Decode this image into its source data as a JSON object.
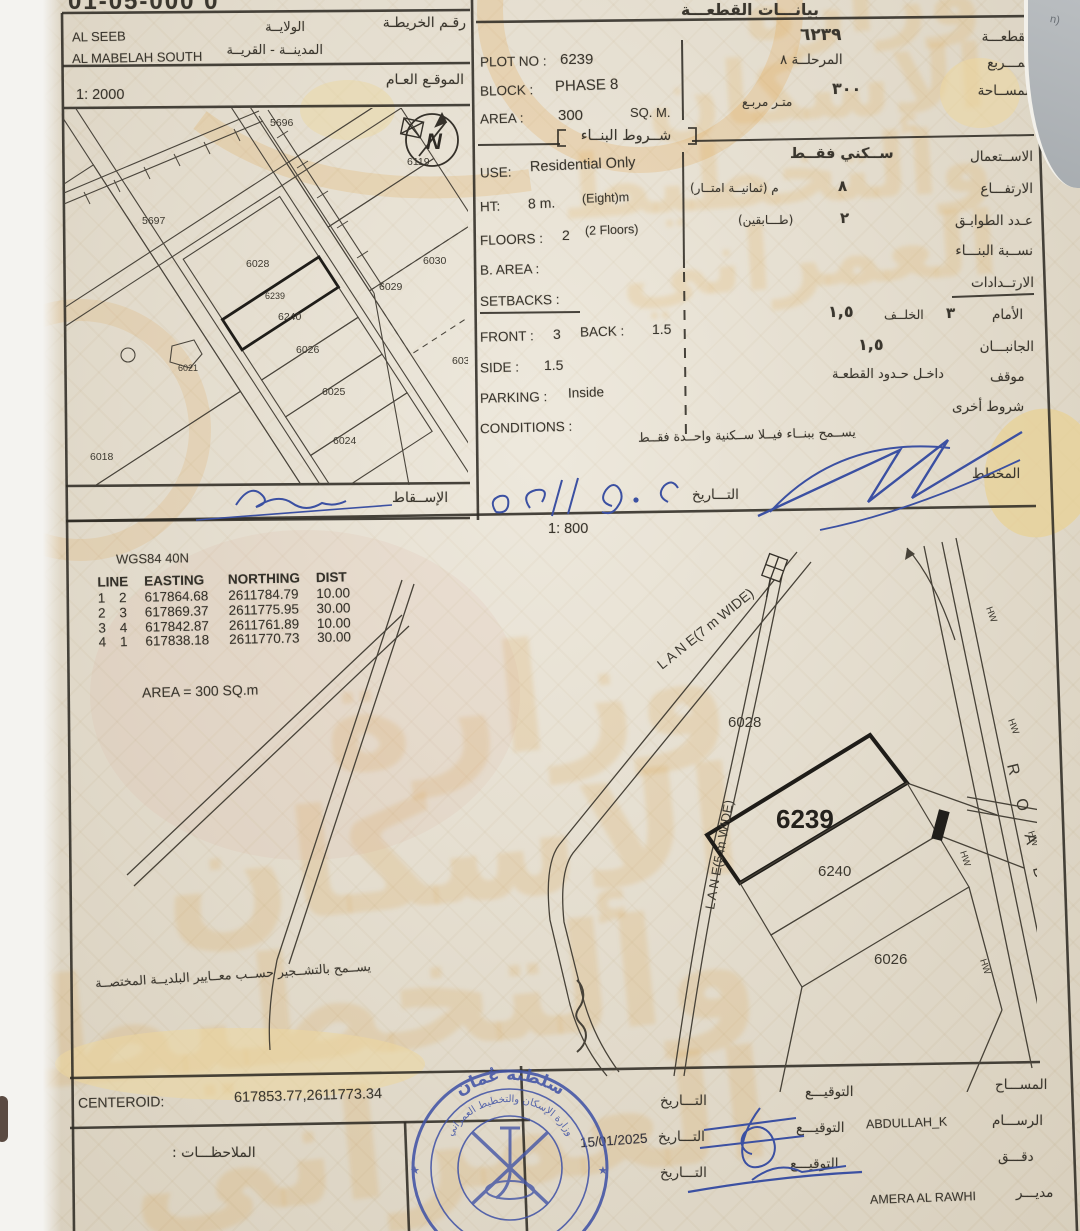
{
  "colors": {
    "paper": "#e7e0d0",
    "ink": "#3a362e",
    "ink_blue": "#3a4fa0",
    "stamp_blue": "#4254a6",
    "watermark_orange": "#d89232"
  },
  "backdrop": {
    "corner_text": "n)"
  },
  "header": {
    "doc_number": "01-05-000 0"
  },
  "location": {
    "map_number_label_ar": "رقـم الخريطـة",
    "wilaya_label_ar": "الولايــة",
    "wilaya_value": "AL SEEB",
    "city_label_ar": "المدينــة - القريــة",
    "city_value": "AL MABELAH SOUTH",
    "site_label_ar": "الموقـع العـام",
    "scale": "1: 2000",
    "projection_label_ar": "الإســقاط"
  },
  "plot": {
    "header_ar": "بيانـــات القطعـــة",
    "plot_label_ar": "القطعـــة",
    "plot_value_ar": "٦٢٣٩",
    "block_label_ar": "المـــربع",
    "block_value_ar": "المرحلــة ٨",
    "area_label_ar": "المســاحة",
    "area_value_ar": "٣٠٠",
    "area_unit_ar": "متـر مربـع",
    "plot_no_label": "PLOT NO :",
    "plot_no": "6239",
    "block_label": "BLOCK :",
    "block": "PHASE 8",
    "area_label": "AREA :",
    "area": "300",
    "area_unit": "SQ. M."
  },
  "conditions": {
    "header_ar": "شــروط البنــاء",
    "use_label_ar": "الاســتعمال",
    "use_value_ar": "ســكني فقــط",
    "height_label_ar": "الارتفـــاع",
    "height_value_ar": "٨",
    "height_note_ar": "م  (ثمانيــة امتــار)",
    "floors_label_ar": "عـدد الطوابـق",
    "floors_value_ar": "٢",
    "floors_note_ar": "(طـــابقين)",
    "ratio_label_ar": "نســبة البنـــاء",
    "setbacks_label_ar": "الارتــدادات",
    "front_label_ar": "الأمام",
    "front_value_ar": "٣",
    "back_label_ar": "الخلــف",
    "back_value_ar": "١,٥",
    "sides_label_ar": "الجانبـــان",
    "sides_value_ar": "١,٥",
    "parking_label_ar": "موقف",
    "parking_value_ar": "داخـل حـدود القطعـة",
    "other_label_ar": "شروط أخرى",
    "note_ar": "يســمح ببنــاء فيــلا ســكنية واحــدة فقــط",
    "planner_label_ar": "المخطط",
    "date_label_ar": "التـــاريخ",
    "use_label": "USE:",
    "use_value": "Residential Only",
    "ht_label": "HT:",
    "ht_value": "8 m.",
    "ht_note": "(Eight)m",
    "floors_label": "FLOORS :",
    "floors_value": "2",
    "floors_note": "(2 Floors)",
    "b_area_label": "B. AREA :",
    "setbacks_label": "SETBACKS :",
    "front_label": "FRONT :",
    "front_value": "3",
    "back_label": "BACK :",
    "back_value": "1.5",
    "side_label": "SIDE :",
    "side_value": "1.5",
    "parking_label": "PARKING :",
    "parking_value": "Inside",
    "conditions_label": "CONDITIONS :"
  },
  "survey": {
    "datum": "WGS84 40N",
    "cols": [
      "LINE",
      "EASTING",
      "NORTHING",
      "DIST"
    ],
    "rows": [
      [
        "1",
        "2",
        "617864.68",
        "2611784.79",
        "10.00"
      ],
      [
        "2",
        "3",
        "617869.37",
        "2611775.95",
        "30.00"
      ],
      [
        "3",
        "4",
        "617842.87",
        "2611761.89",
        "10.00"
      ],
      [
        "4",
        "1",
        "617838.18",
        "2611770.73",
        "30.00"
      ]
    ],
    "area_note": "AREA = 300 SQ.m",
    "scale": "1: 800",
    "greening_note_ar": "يســمح بالتشــجير حســب معــايير البلديــة المختصــة"
  },
  "small_map": {
    "north": "N",
    "plots": {
      "p5696": "5696",
      "p5697": "5697",
      "p6028": "6028",
      "p6030": "6030",
      "p6029": "6029",
      "p6239": "6239",
      "p6240": "6240",
      "p6026": "6026",
      "p6021": "6021",
      "p6025": "6025",
      "p6024": "6024",
      "p6034": "6034",
      "p6018": "6018",
      "p6119": "6119"
    }
  },
  "site_plan": {
    "lane7": "L A N E(7 m WIDE)",
    "lane5": "L A N E(5 m WIDE)",
    "road": "R O A D",
    "hw": "HW",
    "p6028": "6028",
    "p6239": "6239",
    "p6240": "6240",
    "p6026": "6026"
  },
  "footer": {
    "centeroid_label": "CENTEROID:",
    "centeroid_value": "617853.77,2611773.34",
    "notes_label_ar": "الملاحظـــات :",
    "surveyor_label_ar": "المســـاح",
    "sign_label_ar": "التوقيـــع",
    "date_label_ar": "التـــاريخ",
    "draftsman_label_ar": "الرســـام",
    "draftsman_name": "ABDULLAH_K",
    "checked_label_ar": "دقـــق",
    "director_label_ar": "مديـــر",
    "director_name": "AMERA AL RAWHI",
    "date_value": "15/01/2025"
  },
  "stamp": {
    "country_ar": "سلطنة عُمان",
    "ministry_ar": "وزارة الإسكان والتخطيط العمراني",
    "star": "★"
  },
  "watermark_ar": "وزارة الإسكان والتخطيط العمراني"
}
